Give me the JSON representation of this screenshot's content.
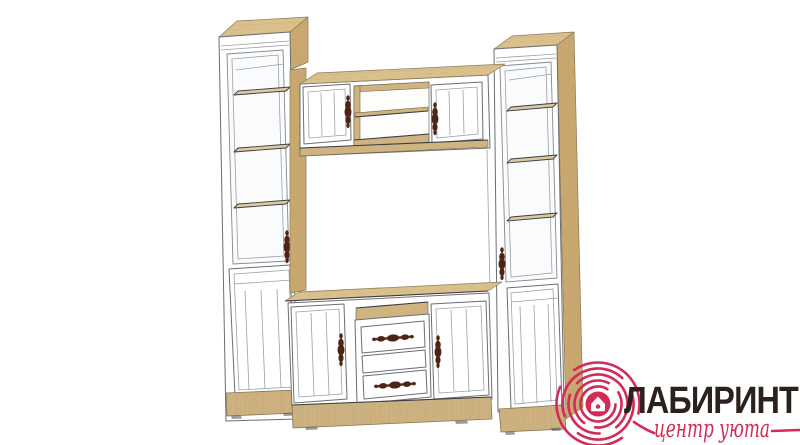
{
  "logo": {
    "title": "ЛАБИРИНТ",
    "subtitle": "центр уюта",
    "icon": "labyrinth-house-icon"
  },
  "colors": {
    "background": "#ffffff",
    "brand_crimson": "#d42a56",
    "brand_dark": "#2c211d",
    "wood_top": "#d9c08c",
    "wood_side": "#c9a870",
    "wood_plinth": "#cdb181",
    "wood_interior": "#cfb380",
    "cabinet_white": "#ffffff",
    "outline": "#6a6f74",
    "handle_bronze": "#4a2416"
  }
}
